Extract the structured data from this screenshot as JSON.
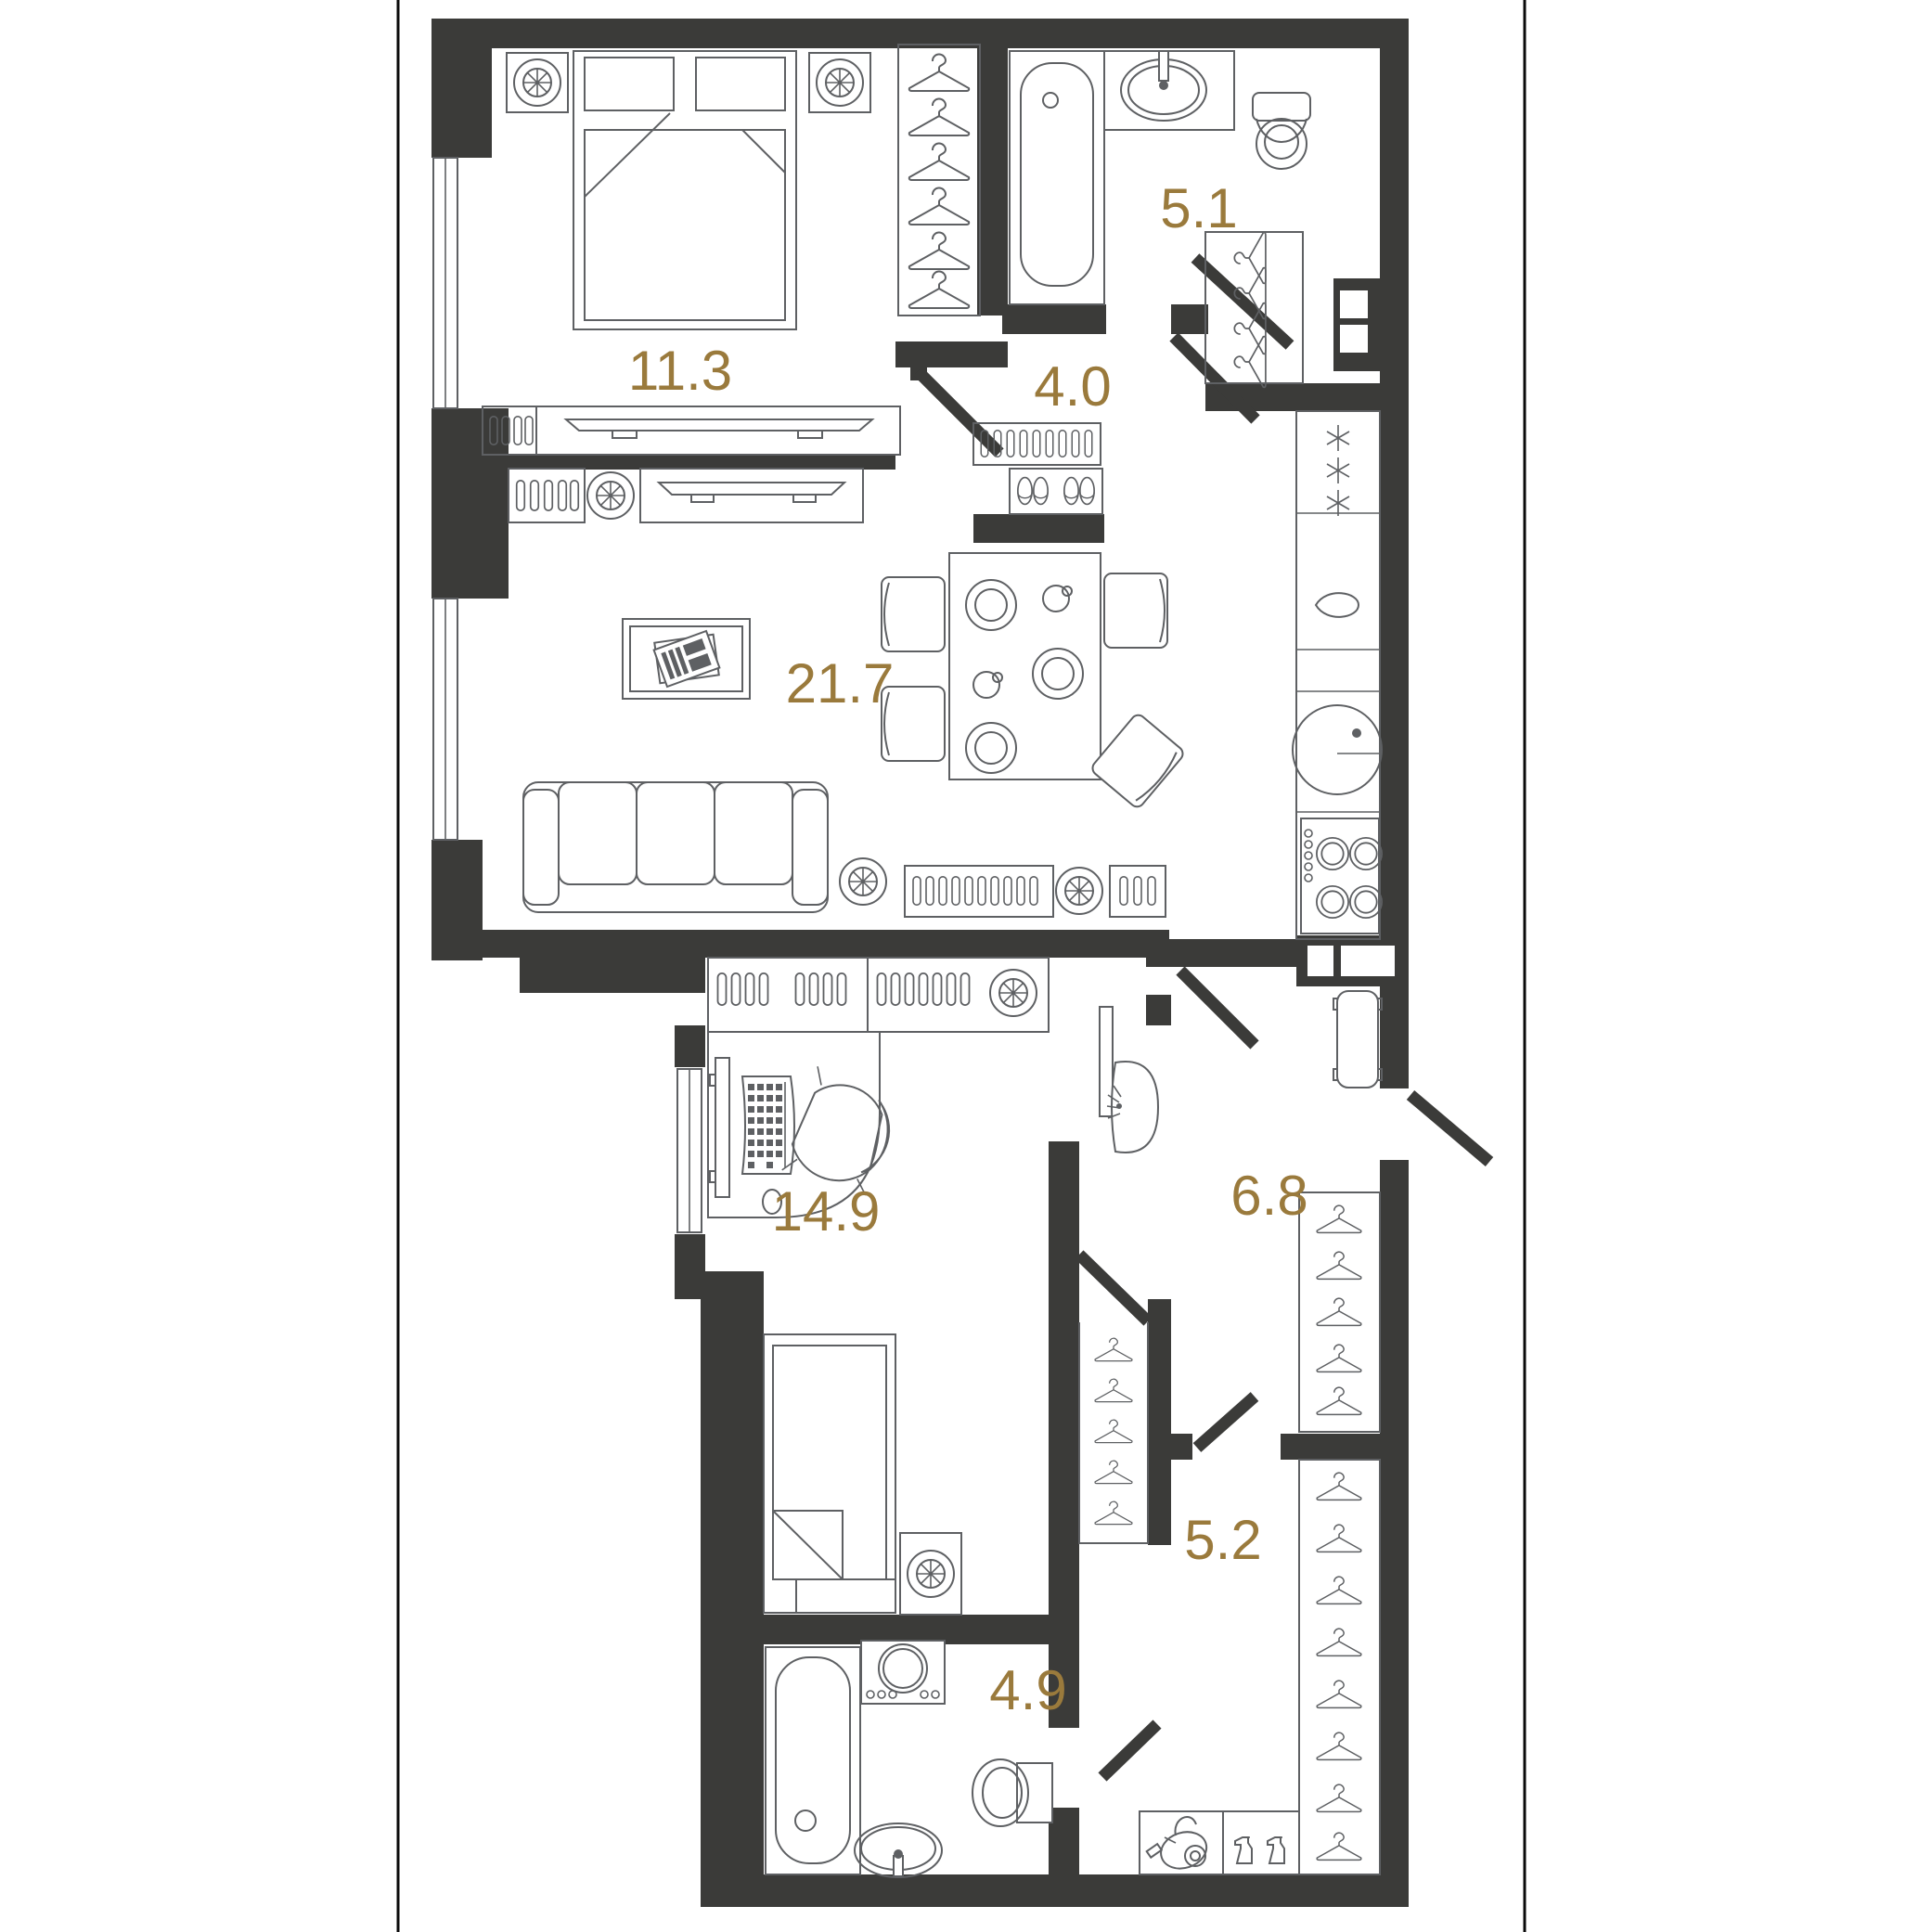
{
  "plan_title": "apartment-floor-plan",
  "colors": {
    "wall": "#3B3B39",
    "furniture_line": "#5E6063",
    "room_label": "#9A7A3C",
    "background": "#FFFFFF",
    "page_border": "#0A0A0A"
  },
  "rooms": [
    {
      "id": "bedroom",
      "label": "11.3"
    },
    {
      "id": "bathroom-top",
      "label": "5.1"
    },
    {
      "id": "hall-top",
      "label": "4.0"
    },
    {
      "id": "living-kitchen",
      "label": "21.7"
    },
    {
      "id": "bedroom-2",
      "label": "14.9"
    },
    {
      "id": "hallway",
      "label": "6.8"
    },
    {
      "id": "wardrobe-room",
      "label": "5.2"
    },
    {
      "id": "bathroom-bottom",
      "label": "4.9"
    }
  ],
  "icons": {
    "hanger": "clothes-hanger outline",
    "fan": "ceiling-vent circle with 8 spokes",
    "snowflake": "fridge frost asterisk",
    "radiator": "rounded slat bars",
    "slippers": "pair of slippers",
    "vacuum": "vacuum cleaner",
    "spray": "spray bottle",
    "tv": "flat tv top view",
    "plate": "dinner plate",
    "cup": "cup top view"
  }
}
